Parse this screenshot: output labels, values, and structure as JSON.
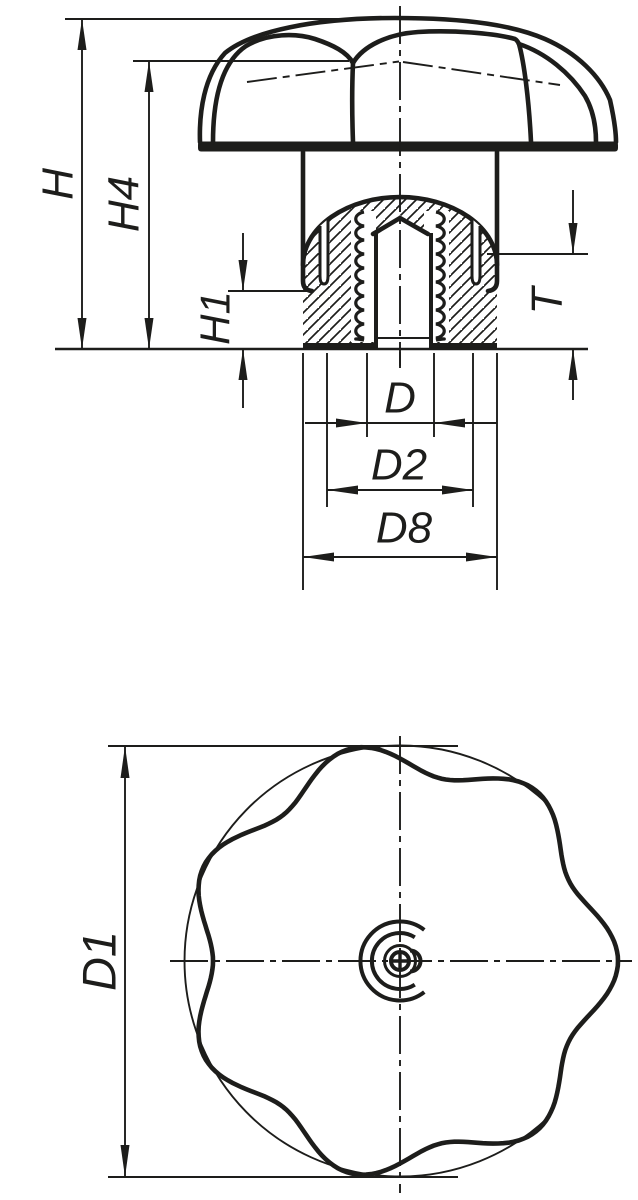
{
  "drawing_title": "star-grip-knob-technical-drawing",
  "colors": {
    "ink": "#1d1d1b",
    "background": "#ffffff"
  },
  "dimension_labels": {
    "h": "H",
    "h4": "H4",
    "h1": "H1",
    "t": "T",
    "d": "D",
    "d2": "D2",
    "d8": "D8",
    "d1": "D1"
  },
  "views": {
    "section_view": "side-section-of-star-grip-with-threaded-bushing",
    "bottom_view": "seven-lobed-star-front-view"
  },
  "star_geometry": {
    "cx": 400,
    "cy": 961,
    "lobes": 7,
    "r_mean": 202.5,
    "r_amplitude": 15.5,
    "phase_deg": 0,
    "circumscribed_circle_r": 215.5,
    "circle_arc_start_deg": 47,
    "circle_arc_end_deg": 313
  },
  "thread_geometry": {
    "top_y": 212,
    "bottom_y": 340,
    "period": 14,
    "left_cusp_x": 364,
    "right_cusp_x": 436,
    "bulge": 11
  }
}
